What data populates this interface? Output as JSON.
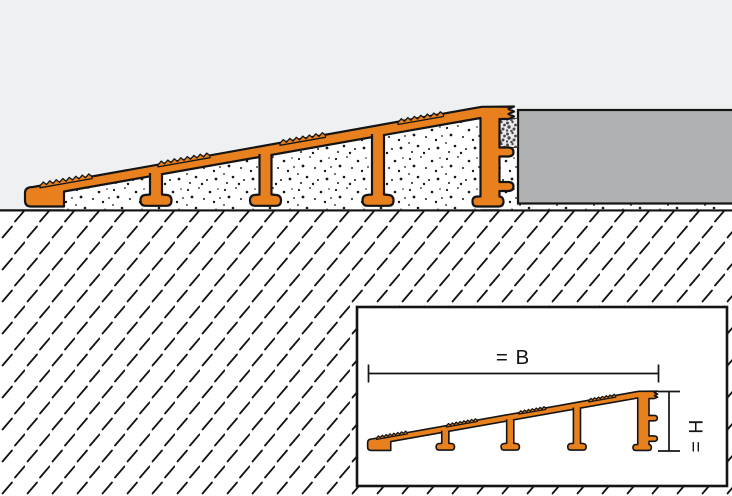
{
  "drawing": {
    "title": "Ramp profile installation cross-section",
    "labels": {
      "width_dim": "= B",
      "height_dim": "= H"
    },
    "colors": {
      "background": "#eff0f1",
      "profile_orange": "#e8801e",
      "outline_black": "#141414",
      "tile_gray": "#b0b1b3",
      "grout_dot": "#4a4a4a",
      "paper_white": "#ffffff"
    },
    "components": {
      "ramp_profile": "sloped ramp transition profile with anchoring legs",
      "mortar_bed": "speckled setting material under profile and tile",
      "grout_joint": "speckled joint between profile end and tile",
      "floor_tile": "gray floor covering at right",
      "substrate": "hatched screed below ground line",
      "inset": "dimension detail of profile width B and height H"
    }
  }
}
